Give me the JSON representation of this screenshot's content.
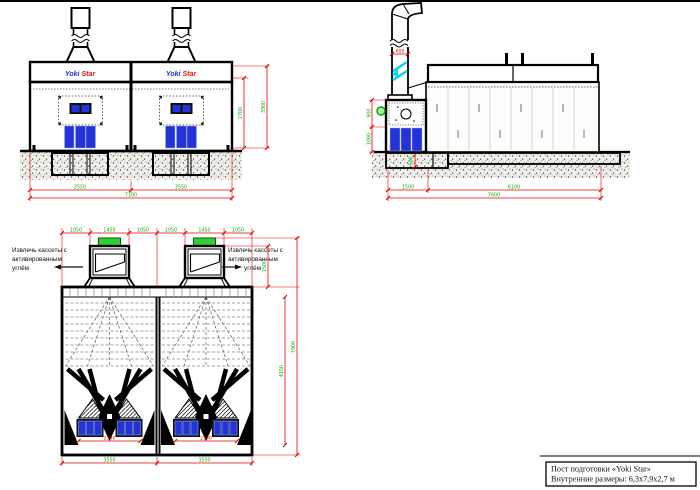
{
  "title_block": {
    "line1": "Пост подготовки «Yoki Star»",
    "line2": "Внутренние размеры: 6,3x7,9x2,7 м"
  },
  "front_view": {
    "logo": {
      "left": "Yoki",
      "right": "Star"
    },
    "dims": {
      "width_left": "3550",
      "width_right": "3550",
      "width_total": "7100",
      "height_inner": "2700",
      "height_outer": "3300"
    }
  },
  "side_view": {
    "dims": {
      "duct_width": "600",
      "left_upper": "900",
      "left_lower": "1000",
      "pit_depth": "500",
      "bottom_left": "1500",
      "bottom_right": "6100",
      "bottom_total": "7600"
    }
  },
  "plan_view": {
    "labels": {
      "extract_left_1": "Извлечь кассеты с",
      "extract_left_2": "активированным",
      "extract_left_3": "углём",
      "extract_right_1": "Извлечь кассеты с",
      "extract_right_2": "активированным",
      "extract_right_3": "углём"
    },
    "dims_top": [
      "1050",
      "1450",
      "1050",
      "1050",
      "1450",
      "1050"
    ],
    "dims": {
      "cassette": "2330",
      "bottom_left": "3550",
      "bottom_right": "3550",
      "funnel_depth": "1500",
      "inner_length": "4150",
      "total_length": "7900"
    }
  },
  "colors": {
    "dim_line": "#ee0000",
    "dim_text": "#00b400",
    "door_blue": "#2433d6",
    "cap_green": "#2fd02f",
    "duct_cyan": "#00d9e9"
  }
}
